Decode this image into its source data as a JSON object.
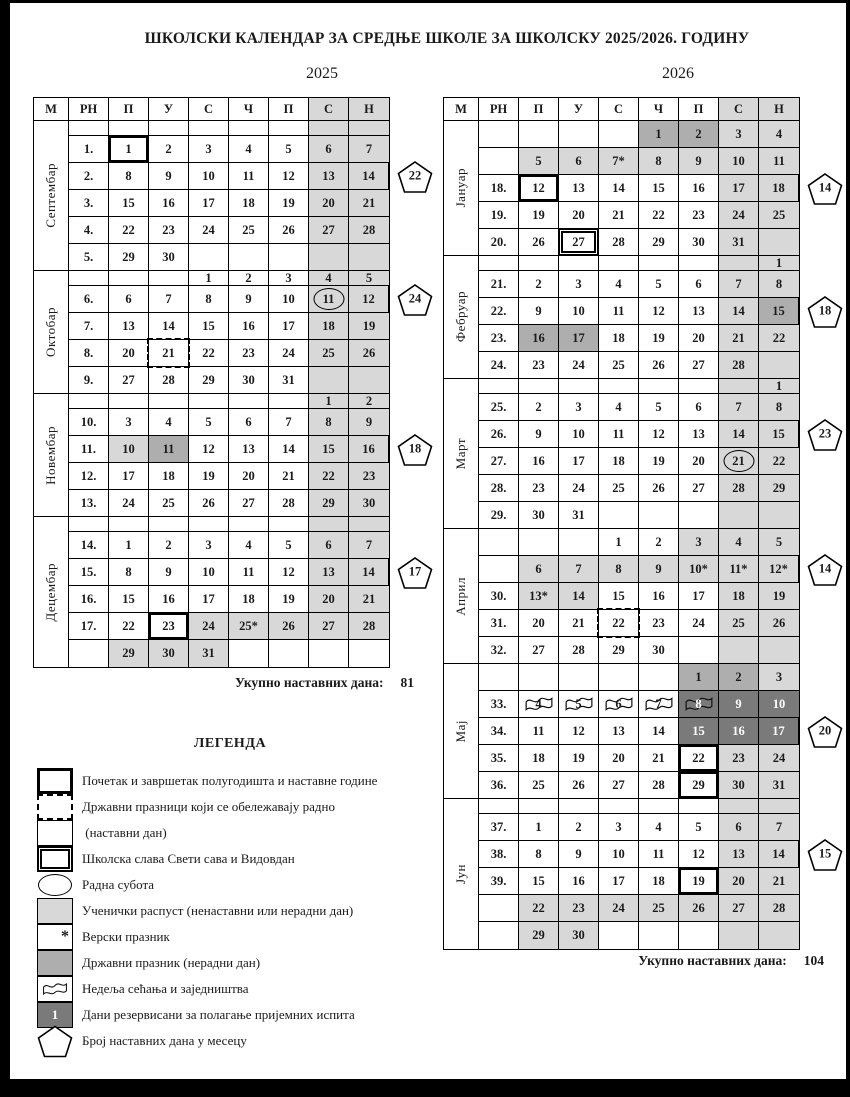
{
  "page": {
    "title": "ШКОЛСКИ КАЛЕНДАР ЗА СРЕДЊЕ ШКОЛЕ ЗА ШКОЛСКУ 2025/2026. ГОДИНУ"
  },
  "colors": {
    "weekend": "#d8d8d8",
    "holiday": "#aeaeae",
    "exam": "#7a7a7a"
  },
  "tables": [
    {
      "year": "2025",
      "header": [
        "М",
        "РН",
        "П",
        "У",
        "С",
        "Ч",
        "П",
        "С",
        "Н"
      ],
      "total_label": "Укупно наставних дана:",
      "total_value": "81",
      "months": [
        {
          "name": "Септембар",
          "pent": "22",
          "pentRow": 2,
          "rows": [
            {
              "w": "",
              "h": "s",
              "c": [
                "",
                "",
                "",
                "",
                "",
                "|g",
                "|g"
              ]
            },
            {
              "w": "1.",
              "c": [
                "1|w|T",
                "2",
                "3",
                "4",
                "5",
                "6|g",
                "7|g"
              ]
            },
            {
              "w": "2.",
              "c": [
                "8",
                "9",
                "10",
                "11",
                "12",
                "13|g",
                "14|g"
              ]
            },
            {
              "w": "3.",
              "c": [
                "15",
                "16",
                "17",
                "18",
                "19",
                "20|g",
                "21|g"
              ]
            },
            {
              "w": "4.",
              "c": [
                "22",
                "23",
                "24",
                "25",
                "26",
                "27|g",
                "28|g"
              ]
            },
            {
              "w": "5.",
              "c": [
                "29",
                "30",
                "",
                "",
                "",
                "|g",
                "|g"
              ]
            }
          ]
        },
        {
          "name": "Октобар",
          "pent": "24",
          "pentRow": 1,
          "rows": [
            {
              "w": "",
              "h": "s",
              "c": [
                "",
                "",
                "1",
                "2",
                "3",
                "4|g",
                "5|g"
              ]
            },
            {
              "w": "6.",
              "c": [
                "6",
                "7",
                "8",
                "9",
                "10",
                "11|g|C",
                "12|g"
              ]
            },
            {
              "w": "7.",
              "c": [
                "13",
                "14",
                "15",
                "16",
                "17",
                "18|g",
                "19|g"
              ]
            },
            {
              "w": "8.",
              "c": [
                "20",
                "21|w|D",
                "22",
                "23",
                "24",
                "25|g",
                "26|g"
              ]
            },
            {
              "w": "9.",
              "c": [
                "27",
                "28",
                "29",
                "30",
                "31",
                "|g",
                "|g"
              ]
            }
          ]
        },
        {
          "name": "Новембар",
          "pent": "18",
          "pentRow": 2,
          "rows": [
            {
              "w": "",
              "h": "s",
              "c": [
                "",
                "",
                "",
                "",
                "",
                "1|g",
                "2|g"
              ]
            },
            {
              "w": "10.",
              "c": [
                "3",
                "4",
                "5",
                "6",
                "7",
                "8|g",
                "9|g"
              ]
            },
            {
              "w": "11.",
              "c": [
                "10|g",
                "11|h",
                "12",
                "13",
                "14",
                "15|g",
                "16|g"
              ]
            },
            {
              "w": "12.",
              "c": [
                "17",
                "18",
                "19",
                "20",
                "21",
                "22|g",
                "23|g"
              ]
            },
            {
              "w": "13.",
              "c": [
                "24",
                "25",
                "26",
                "27",
                "28",
                "29|g",
                "30|g"
              ]
            }
          ]
        },
        {
          "name": "Децембар",
          "pent": "17",
          "pentRow": 2,
          "rows": [
            {
              "w": "",
              "h": "s",
              "c": [
                "",
                "",
                "",
                "",
                "",
                "|g",
                "|g"
              ]
            },
            {
              "w": "14.",
              "c": [
                "1",
                "2",
                "3",
                "4",
                "5",
                "6|g",
                "7|g"
              ]
            },
            {
              "w": "15.",
              "c": [
                "8",
                "9",
                "10",
                "11",
                "12",
                "13|g",
                "14|g"
              ]
            },
            {
              "w": "16.",
              "c": [
                "15",
                "16",
                "17",
                "18",
                "19",
                "20|g",
                "21|g"
              ]
            },
            {
              "w": "17.",
              "c": [
                "22",
                "23|w|T",
                "24|g",
                "25*|g",
                "26|g",
                "27|g",
                "28|g"
              ]
            },
            {
              "w": "",
              "c": [
                "29|g",
                "30|g",
                "31|g",
                "",
                "",
                "",
                ""
              ]
            }
          ]
        }
      ]
    },
    {
      "year": "2026",
      "header": [
        "М",
        "РН",
        "П",
        "У",
        "С",
        "Ч",
        "П",
        "С",
        "Н"
      ],
      "total_label": "Укупно наставних дана:",
      "total_value": "104",
      "months": [
        {
          "name": "Јануар",
          "pent": "14",
          "pentRow": 2,
          "rows": [
            {
              "w": "",
              "c": [
                "",
                "",
                "",
                "1|h",
                "2|h",
                "3|g",
                "4|g"
              ]
            },
            {
              "w": "",
              "c": [
                "5|g",
                "6|g",
                "7*|g",
                "8|g",
                "9|g",
                "10|g",
                "11|g"
              ]
            },
            {
              "w": "18.",
              "c": [
                "12|w|T",
                "13",
                "14",
                "15",
                "16",
                "17|g",
                "18|g"
              ]
            },
            {
              "w": "19.",
              "c": [
                "19",
                "20",
                "21",
                "22",
                "23",
                "24|g",
                "25|g"
              ]
            },
            {
              "w": "20.",
              "c": [
                "26",
                "27|w|B",
                "28",
                "29",
                "30",
                "31|g",
                "|g"
              ]
            }
          ]
        },
        {
          "name": "Фебруар",
          "pent": "18",
          "pentRow": 2,
          "rows": [
            {
              "w": "",
              "h": "s",
              "c": [
                "",
                "",
                "",
                "",
                "",
                "|g",
                "1|g"
              ]
            },
            {
              "w": "21.",
              "c": [
                "2",
                "3",
                "4",
                "5",
                "6",
                "7|g",
                "8|g"
              ]
            },
            {
              "w": "22.",
              "c": [
                "9",
                "10",
                "11",
                "12",
                "13",
                "14|g",
                "15|h"
              ]
            },
            {
              "w": "23.",
              "c": [
                "16|h",
                "17|h",
                "18",
                "19",
                "20",
                "21|g",
                "22|g"
              ]
            },
            {
              "w": "24.",
              "c": [
                "23",
                "24",
                "25",
                "26",
                "27",
                "28|g",
                "|g"
              ]
            }
          ]
        },
        {
          "name": "Март",
          "pent": "23",
          "pentRow": 2,
          "rows": [
            {
              "w": "",
              "h": "s",
              "c": [
                "",
                "",
                "",
                "",
                "",
                "|g",
                "1|g"
              ]
            },
            {
              "w": "25.",
              "c": [
                "2",
                "3",
                "4",
                "5",
                "6",
                "7|g",
                "8|g"
              ]
            },
            {
              "w": "26.",
              "c": [
                "9",
                "10",
                "11",
                "12",
                "13",
                "14|g",
                "15|g"
              ]
            },
            {
              "w": "27.",
              "c": [
                "16",
                "17",
                "18",
                "19",
                "20",
                "21|g|C",
                "22|g"
              ]
            },
            {
              "w": "28.",
              "c": [
                "23",
                "24",
                "25",
                "26",
                "27",
                "28|g",
                "29|g"
              ]
            },
            {
              "w": "29.",
              "c": [
                "30",
                "31",
                "",
                "",
                "",
                "|g",
                "|g"
              ]
            }
          ]
        },
        {
          "name": "Април",
          "pent": "14",
          "pentRow": 1,
          "rows": [
            {
              "w": "",
              "c": [
                "",
                "",
                "1",
                "2",
                "3|g",
                "4|g",
                "5|g"
              ]
            },
            {
              "w": "",
              "c": [
                "6|g",
                "7|g",
                "8|g",
                "9|g",
                "10*|g",
                "11*|g",
                "12*|g"
              ]
            },
            {
              "w": "30.",
              "c": [
                "13*|g",
                "14|g",
                "15",
                "16",
                "17",
                "18|g",
                "19|g"
              ]
            },
            {
              "w": "31.",
              "c": [
                "20",
                "21",
                "22|w|D",
                "23",
                "24",
                "25|g",
                "26|g"
              ]
            },
            {
              "w": "32.",
              "c": [
                "27",
                "28",
                "29",
                "30",
                "",
                "|g",
                "|g"
              ]
            }
          ]
        },
        {
          "name": "Мај",
          "pent": "20",
          "pentRow": 2,
          "rows": [
            {
              "w": "",
              "c": [
                "",
                "",
                "",
                "",
                "1|h",
                "2|h",
                "3|g"
              ]
            },
            {
              "w": "33.",
              "c": [
                "4|w|F",
                "5|w|F",
                "6|w|F",
                "7|w|F",
                "8|x|F",
                "9|x",
                "10|x"
              ]
            },
            {
              "w": "34.",
              "c": [
                "11",
                "12",
                "13",
                "14",
                "15|x",
                "16|x",
                "17|x"
              ]
            },
            {
              "w": "35.",
              "c": [
                "18",
                "19",
                "20",
                "21",
                "22|w|T",
                "23|g",
                "24|g"
              ]
            },
            {
              "w": "36.",
              "c": [
                "25",
                "26",
                "27",
                "28",
                "29|w|T",
                "30|g",
                "31|g"
              ]
            }
          ]
        },
        {
          "name": "Јун",
          "pent": "15",
          "pentRow": 2,
          "rows": [
            {
              "w": "",
              "h": "s",
              "c": [
                "",
                "",
                "",
                "",
                "",
                "|g",
                "|g"
              ]
            },
            {
              "w": "37.",
              "c": [
                "1",
                "2",
                "3",
                "4",
                "5",
                "6|g",
                "7|g"
              ]
            },
            {
              "w": "38.",
              "c": [
                "8",
                "9",
                "10",
                "11",
                "12",
                "13|g",
                "14|g"
              ]
            },
            {
              "w": "39.",
              "c": [
                "15",
                "16",
                "17",
                "18",
                "19|w|T",
                "20|g",
                "21|g"
              ]
            },
            {
              "w": "",
              "c": [
                "22|g",
                "23|g",
                "24|g",
                "25|g",
                "26|g",
                "27|g",
                "28|g"
              ]
            },
            {
              "w": "",
              "c": [
                "29|g",
                "30|g",
                "",
                "",
                "",
                "|g",
                "|g"
              ]
            }
          ]
        }
      ]
    }
  ],
  "legend": {
    "title": "ЛЕГЕНДА",
    "items": [
      {
        "swatch": "thick",
        "label": "Почетак и завршетак полугодишта и наставне године"
      },
      {
        "swatch": "dashed",
        "label": "Државни празници који се обележавају радно"
      },
      {
        "swatch": "plain",
        "label": " (наставни дан)"
      },
      {
        "swatch": "double",
        "label": "Школска слава Свети сава и Видовдан"
      },
      {
        "swatch": "ellipse",
        "label": "Радна субота"
      },
      {
        "swatch": "vacation",
        "label": "Ученички распуст (ненаставни или нерадни дан)"
      },
      {
        "swatch": "asterisk",
        "label": "Верски празник",
        "swatch_text": "*"
      },
      {
        "swatch": "holiday",
        "label": "Државни празник (нерадни дан)"
      },
      {
        "swatch": "flag",
        "label": "Недеља сећања и заједништва"
      },
      {
        "swatch": "exam",
        "label": "Дани резервисани за полагање пријемних испита",
        "swatch_text": "1"
      },
      {
        "swatch": "pentagon",
        "label": "Број наставних дана у месецу"
      }
    ]
  }
}
